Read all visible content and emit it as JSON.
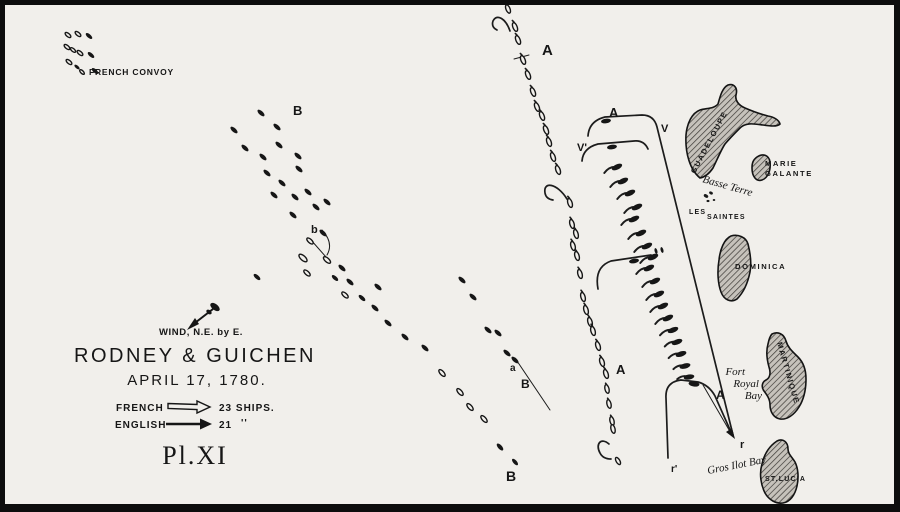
{
  "title_block": {
    "wind": "WIND, N.E. by E.",
    "title": "RODNEY & GUICHEN",
    "date": "APRIL 17, 1780.",
    "plate": "Pl.XI"
  },
  "legend": {
    "french": {
      "side": "FRENCH",
      "count": "23 SHIPS.",
      "symbol": "hollow-arrow"
    },
    "english": {
      "side": "ENGLISH",
      "count": "21",
      "ditto": "''",
      "symbol": "solid-arrow"
    }
  },
  "places": {
    "convoy": "FRENCH CONVOY",
    "guadeloupe": "GUADELOUPE",
    "basse_terre": "Basse Terre",
    "marie_galante_1": "MARIE",
    "marie_galante_2": "GALANTE",
    "les_saintes_1": "LES",
    "les_saintes_2": "SAINTES",
    "dominica": "DOMINICA",
    "martinique": "MARTINIQUE",
    "fort_royal": [
      "Fort",
      "Royal",
      "Bay"
    ],
    "gros_ilot": "Gros Ilot Bay",
    "st_lucia": "ST.LUCIA"
  },
  "colors": {
    "paper": "#f1efeb",
    "ink": "#161616",
    "island_fill": "#c6c2bb"
  },
  "track_letters": [
    {
      "t": "A",
      "x": 537,
      "y": 50,
      "fs": 15
    },
    {
      "t": "A",
      "x": 604,
      "y": 112,
      "fs": 13
    },
    {
      "t": "V",
      "x": 656,
      "y": 127,
      "fs": 11
    },
    {
      "t": "V'",
      "x": 572,
      "y": 146,
      "fs": 11
    },
    {
      "t": "B",
      "x": 288,
      "y": 110,
      "fs": 13
    },
    {
      "t": "b",
      "x": 306,
      "y": 228,
      "fs": 11
    },
    {
      "t": "a",
      "x": 505,
      "y": 366,
      "fs": 10
    },
    {
      "t": "B",
      "x": 516,
      "y": 383,
      "fs": 12
    },
    {
      "t": "B",
      "x": 501,
      "y": 476,
      "fs": 14
    },
    {
      "t": "A",
      "x": 611,
      "y": 369,
      "fs": 13
    },
    {
      "t": "A",
      "x": 711,
      "y": 394,
      "fs": 12
    },
    {
      "t": "r",
      "x": 735,
      "y": 443,
      "fs": 11
    },
    {
      "t": "r'",
      "x": 666,
      "y": 467,
      "fs": 10
    }
  ],
  "ships": [
    [
      63,
      30,
      40,
      "h",
      3.5,
      0
    ],
    [
      73,
      29,
      40,
      "h",
      3.5,
      0
    ],
    [
      84,
      31,
      40,
      "s",
      4,
      0
    ],
    [
      62,
      42,
      40,
      "h",
      3.5,
      0
    ],
    [
      68,
      45,
      40,
      "h",
      3.2,
      0
    ],
    [
      75,
      48,
      40,
      "h",
      3.5,
      0
    ],
    [
      86,
      50,
      40,
      "s",
      4,
      0
    ],
    [
      64,
      57,
      40,
      "h",
      3.5,
      0
    ],
    [
      72,
      62,
      40,
      "s",
      3.2,
      0
    ],
    [
      90,
      66,
      40,
      "s",
      4,
      0
    ],
    [
      77,
      67,
      45,
      "h",
      3,
      0
    ],
    [
      503,
      4,
      68,
      "h",
      4.4,
      6
    ],
    [
      510,
      22,
      68,
      "h",
      4.6,
      7
    ],
    [
      513,
      35,
      68,
      "h",
      4.6,
      7
    ],
    [
      518,
      55,
      68,
      "h",
      4.6,
      7
    ],
    [
      523,
      70,
      68,
      "h",
      4.6,
      7
    ],
    [
      528,
      87,
      68,
      "h",
      4.6,
      7
    ],
    [
      532,
      102,
      68,
      "h",
      4.6,
      7
    ],
    [
      537,
      111,
      68,
      "h",
      4.6,
      7
    ],
    [
      541,
      125,
      68,
      "h",
      4.6,
      7
    ],
    [
      544,
      137,
      70,
      "h",
      4.6,
      7
    ],
    [
      548,
      152,
      70,
      "h",
      4.6,
      7
    ],
    [
      553,
      165,
      70,
      "h",
      4.6,
      7
    ],
    [
      565,
      198,
      72,
      "h",
      4.6,
      7
    ],
    [
      567,
      219,
      74,
      "h",
      4.6,
      7
    ],
    [
      571,
      229,
      74,
      "h",
      4.6,
      7
    ],
    [
      568,
      241,
      74,
      "h",
      4.6,
      7
    ],
    [
      572,
      251,
      74,
      "h",
      4.6,
      7
    ],
    [
      575,
      269,
      74,
      "h",
      4.6,
      7
    ],
    [
      578,
      292,
      74,
      "h",
      4.6,
      7
    ],
    [
      581,
      305,
      74,
      "h",
      4.6,
      7
    ],
    [
      585,
      317,
      74,
      "h",
      4.6,
      7
    ],
    [
      588,
      326,
      74,
      "h",
      4.6,
      7
    ],
    [
      593,
      341,
      72,
      "h",
      4.6,
      7
    ],
    [
      597,
      357,
      72,
      "h",
      4.6,
      7
    ],
    [
      601,
      369,
      72,
      "h",
      4.6,
      7
    ],
    [
      602,
      384,
      76,
      "h",
      4.4,
      6
    ],
    [
      604,
      399,
      76,
      "h",
      4.4,
      6
    ],
    [
      607,
      416,
      76,
      "h",
      4.4,
      6
    ],
    [
      608,
      424,
      76,
      "h",
      4.4,
      0
    ],
    [
      613,
      456,
      60,
      "h",
      4,
      0
    ],
    [
      256,
      108,
      42,
      "s",
      4.4,
      0
    ],
    [
      272,
      122,
      42,
      "s",
      4.4,
      0
    ],
    [
      229,
      125,
      42,
      "s",
      4.4,
      0
    ],
    [
      240,
      143,
      42,
      "s",
      4.4,
      0
    ],
    [
      258,
      152,
      42,
      "s",
      4.4,
      0
    ],
    [
      274,
      140,
      42,
      "s",
      4.4,
      0
    ],
    [
      293,
      151,
      42,
      "s",
      4.4,
      0
    ],
    [
      262,
      168,
      42,
      "s",
      4.4,
      0
    ],
    [
      277,
      178,
      42,
      "s",
      4.4,
      0
    ],
    [
      294,
      164,
      42,
      "s",
      4.4,
      0
    ],
    [
      269,
      190,
      42,
      "s",
      4.4,
      0
    ],
    [
      290,
      192,
      42,
      "s",
      4.4,
      0
    ],
    [
      303,
      187,
      42,
      "s",
      4.4,
      0
    ],
    [
      322,
      197,
      42,
      "s",
      4.4,
      0
    ],
    [
      288,
      210,
      42,
      "s",
      4.4,
      0
    ],
    [
      311,
      202,
      42,
      "s",
      4.4,
      0
    ],
    [
      318,
      228,
      42,
      "s",
      4.4,
      0
    ],
    [
      298,
      253,
      42,
      "h",
      5,
      0
    ],
    [
      305,
      236,
      42,
      "h",
      4,
      0
    ],
    [
      322,
      255,
      42,
      "h",
      4.4,
      0
    ],
    [
      337,
      263,
      42,
      "s",
      4.4,
      0
    ],
    [
      302,
      268,
      42,
      "h",
      4,
      0
    ],
    [
      252,
      272,
      42,
      "s",
      4.2,
      0
    ],
    [
      330,
      273,
      42,
      "s",
      4,
      0
    ],
    [
      345,
      277,
      42,
      "s",
      4.4,
      0
    ],
    [
      340,
      290,
      42,
      "h",
      4,
      0
    ],
    [
      373,
      282,
      42,
      "s",
      4.4,
      0
    ],
    [
      357,
      293,
      42,
      "s",
      4.2,
      0
    ],
    [
      370,
      303,
      42,
      "s",
      4.4,
      0
    ],
    [
      383,
      318,
      42,
      "s",
      4.4,
      0
    ],
    [
      400,
      332,
      42,
      "s",
      4.4,
      0
    ],
    [
      420,
      343,
      42,
      "s",
      4.4,
      0
    ],
    [
      457,
      275,
      42,
      "s",
      4.4,
      0
    ],
    [
      468,
      292,
      42,
      "s",
      4.4,
      0
    ],
    [
      483,
      325,
      42,
      "s",
      4.4,
      0
    ],
    [
      493,
      328,
      42,
      "s",
      4.4,
      0
    ],
    [
      502,
      348,
      42,
      "s",
      4.4,
      0
    ],
    [
      510,
      355,
      42,
      "s",
      4.4,
      0
    ],
    [
      437,
      368,
      48,
      "h",
      4.2,
      0
    ],
    [
      455,
      387,
      48,
      "h",
      4.2,
      0
    ],
    [
      465,
      402,
      48,
      "h",
      4.2,
      0
    ],
    [
      479,
      414,
      48,
      "h",
      4.2,
      0
    ],
    [
      495,
      442,
      48,
      "s",
      4.4,
      0
    ],
    [
      510,
      457,
      48,
      "s",
      4,
      0
    ],
    [
      612,
      162,
      -25,
      "s",
      5.6,
      14
    ],
    [
      618,
      176,
      -25,
      "s",
      5.6,
      14
    ],
    [
      625,
      188,
      -25,
      "s",
      5.6,
      14
    ],
    [
      632,
      202,
      -25,
      "s",
      5.6,
      14
    ],
    [
      629,
      214,
      -25,
      "s",
      5.6,
      14
    ],
    [
      636,
      228,
      -25,
      "s",
      5.6,
      14
    ],
    [
      642,
      241,
      -25,
      "s",
      5.6,
      14
    ],
    [
      648,
      252,
      -25,
      "s",
      5.6,
      14
    ],
    [
      644,
      263,
      -25,
      "s",
      5.6,
      14
    ],
    [
      650,
      276,
      -25,
      "s",
      5.6,
      14
    ],
    [
      654,
      289,
      -25,
      "s",
      5.6,
      14
    ],
    [
      658,
      301,
      -25,
      "s",
      5.6,
      14
    ],
    [
      663,
      313,
      -25,
      "s",
      5.6,
      14
    ],
    [
      668,
      325,
      -22,
      "s",
      5.6,
      14
    ],
    [
      672,
      337,
      -20,
      "s",
      5.6,
      13
    ],
    [
      676,
      349,
      -18,
      "s",
      5.6,
      13
    ],
    [
      680,
      361,
      -15,
      "s",
      5.6,
      12
    ],
    [
      684,
      372,
      -10,
      "s",
      5.4,
      12
    ],
    [
      601,
      116,
      -8,
      "s",
      5,
      0
    ],
    [
      607,
      142,
      -8,
      "s",
      5,
      0
    ],
    [
      629,
      256,
      -10,
      "s",
      5,
      0
    ],
    [
      689,
      379,
      8,
      "s",
      5.5,
      0
    ],
    [
      651,
      246,
      75,
      "s",
      3,
      0
    ],
    [
      657,
      245,
      75,
      "s",
      3,
      0
    ]
  ]
}
